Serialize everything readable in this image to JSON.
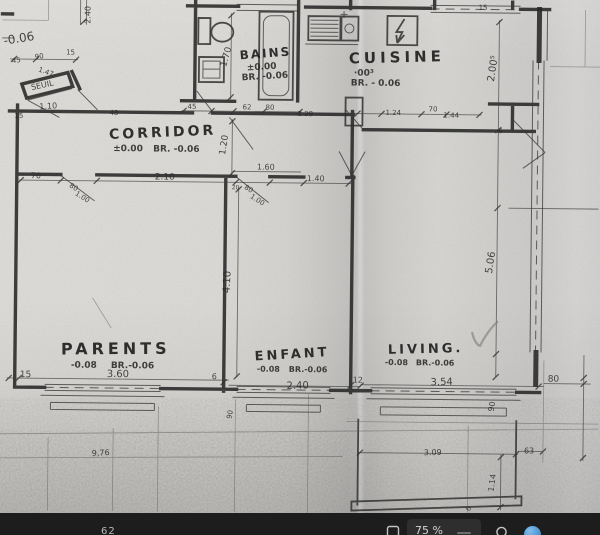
{
  "viewer": {
    "toolbar": {
      "left_label": "62",
      "zoom_label": "75 %"
    }
  },
  "plan": {
    "rooms": {
      "bains": {
        "name": "BAINS",
        "level": "±0.00",
        "remark": "BR. -0.06"
      },
      "cuisine": {
        "name": "CUISINE",
        "level": "·00³",
        "remark": "BR. - 0.06"
      },
      "corridor": {
        "name": "CORRIDOR",
        "level": "±0.00",
        "remark": "BR. -0.06"
      },
      "parents": {
        "name": "PARENTS",
        "level": "-0.08",
        "remark": "BR.-0.06"
      },
      "enfant": {
        "name": "ENFANT",
        "level": "-0.08",
        "remark": "BR.-0.06"
      },
      "living": {
        "name": "LIVING.",
        "level": "-0.08",
        "remark": "BR.-0.06"
      }
    },
    "dim_labels": [
      {
        "t": "-0.06",
        "x": 2,
        "y": 48,
        "r": -10,
        "s": 12
      },
      {
        "t": "2.40",
        "x": 88,
        "y": 26,
        "r": -90,
        "s": 8
      },
      {
        "t": "45",
        "x": 10,
        "y": 66,
        "r": -6,
        "s": 7
      },
      {
        "t": "90",
        "x": 33,
        "y": 62,
        "r": -8,
        "s": 7
      },
      {
        "t": "1.47",
        "x": 36,
        "y": 74,
        "r": 20,
        "s": 7
      },
      {
        "t": "15",
        "x": 64,
        "y": 57,
        "r": 0,
        "s": 7
      },
      {
        "t": "SEUIL",
        "x": 30,
        "y": 93,
        "r": -13,
        "s": 8
      },
      {
        "t": "1.10",
        "x": 38,
        "y": 112,
        "r": -4,
        "s": 8
      },
      {
        "t": "15",
        "x": 13,
        "y": 121,
        "r": 0,
        "s": 7
      },
      {
        "t": "48",
        "x": 108,
        "y": 117,
        "r": 0,
        "s": 7
      },
      {
        "t": "1.70",
        "x": 224,
        "y": 68,
        "r": -75,
        "s": 9
      },
      {
        "t": "45",
        "x": 186,
        "y": 110,
        "r": 0,
        "s": 7
      },
      {
        "t": "62",
        "x": 241,
        "y": 110,
        "r": 0,
        "s": 7
      },
      {
        "t": "80",
        "x": 264,
        "y": 110,
        "r": 0,
        "s": 7
      },
      {
        "t": "2.00⁵",
        "x": 492,
        "y": 80,
        "r": -82,
        "s": 10
      },
      {
        "t": "15",
        "x": 476,
        "y": 8,
        "r": 0,
        "s": 7
      },
      {
        "t": "70",
        "x": 30,
        "y": 181,
        "r": 0,
        "s": 8
      },
      {
        "t": "2.10",
        "x": 154,
        "y": 181,
        "r": 0,
        "s": 9
      },
      {
        "t": "80",
        "x": 68,
        "y": 189,
        "r": 32,
        "s": 7
      },
      {
        "t": "1.00",
        "x": 74,
        "y": 197,
        "r": 32,
        "s": 7
      },
      {
        "t": "20",
        "x": 231,
        "y": 190,
        "r": 0,
        "s": 6
      },
      {
        "t": "80",
        "x": 243,
        "y": 189,
        "r": 32,
        "s": 7
      },
      {
        "t": "1.00",
        "x": 249,
        "y": 198,
        "r": 32,
        "s": 7
      },
      {
        "t": "1.20",
        "x": 224,
        "y": 156,
        "r": -82,
        "s": 9
      },
      {
        "t": "1.60",
        "x": 256,
        "y": 170,
        "r": 0,
        "s": 8
      },
      {
        "t": "1.40",
        "x": 306,
        "y": 181,
        "r": 0,
        "s": 8
      },
      {
        "t": "1.28",
        "x": 296,
        "y": 116,
        "r": 0,
        "s": 7
      },
      {
        "t": "1.24",
        "x": 384,
        "y": 114,
        "r": 0,
        "s": 7
      },
      {
        "t": "70",
        "x": 427,
        "y": 110,
        "r": 0,
        "s": 7
      },
      {
        "t": "1.44",
        "x": 442,
        "y": 116,
        "r": 0,
        "s": 7
      },
      {
        "t": "5.06",
        "x": 492,
        "y": 272,
        "r": -82,
        "s": 10
      },
      {
        "t": "6",
        "x": 497,
        "y": 131,
        "r": 0,
        "s": 7
      },
      {
        "t": "4.10",
        "x": 230,
        "y": 294,
        "r": -88,
        "s": 10
      },
      {
        "t": "15",
        "x": 21,
        "y": 380,
        "r": 0,
        "s": 9
      },
      {
        "t": "3.60",
        "x": 108,
        "y": 379,
        "r": 0,
        "s": 10
      },
      {
        "t": "6",
        "x": 213,
        "y": 380,
        "r": 0,
        "s": 8
      },
      {
        "t": "2.40",
        "x": 288,
        "y": 389,
        "r": -2,
        "s": 10
      },
      {
        "t": "12",
        "x": 354,
        "y": 382,
        "r": 0,
        "s": 8
      },
      {
        "t": "3.54",
        "x": 432,
        "y": 384,
        "r": -2,
        "s": 10
      },
      {
        "t": "80",
        "x": 549,
        "y": 379,
        "r": 0,
        "s": 9
      },
      {
        "t": "90",
        "x": 495,
        "y": 410,
        "r": -80,
        "s": 8
      },
      {
        "t": "90",
        "x": 233,
        "y": 420,
        "r": -80,
        "s": 7
      },
      {
        "t": "9,76",
        "x": 94,
        "y": 458,
        "r": -3,
        "s": 8
      },
      {
        "t": "3.09",
        "x": 426,
        "y": 454,
        "r": -2,
        "s": 8
      },
      {
        "t": "63",
        "x": 526,
        "y": 451,
        "r": 0,
        "s": 8
      },
      {
        "t": "1.14",
        "x": 496,
        "y": 490,
        "r": -83,
        "s": 8
      },
      {
        "t": "6",
        "x": 472,
        "y": 510,
        "r": -60,
        "s": 7
      }
    ]
  }
}
